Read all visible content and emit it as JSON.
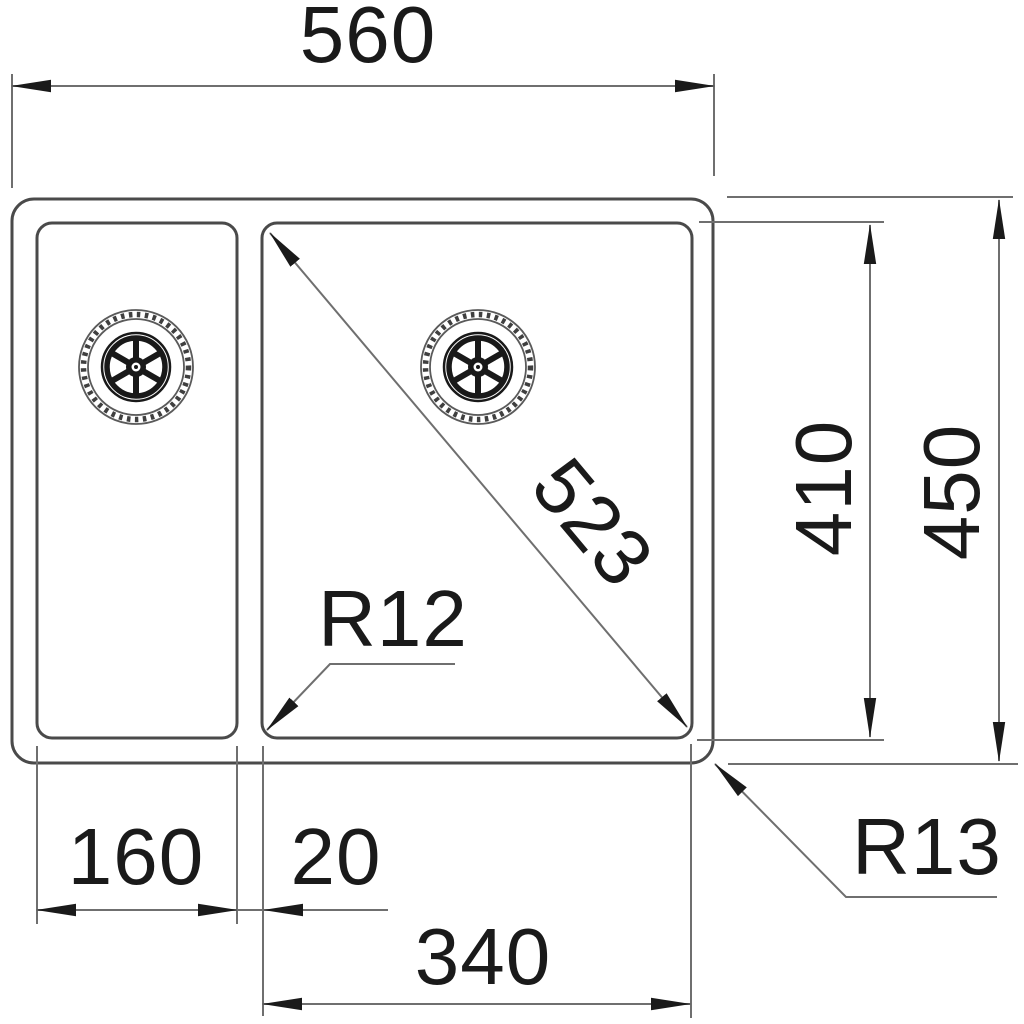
{
  "drawing": {
    "subject": "one-and-a-half-bowl sink top view dimension drawing",
    "labels": {
      "overall_width": "560",
      "overall_depth": "450",
      "bowl_depth": "410",
      "bowl_diagonal": "523",
      "left_bowl_width": "160",
      "divider_width": "20",
      "right_bowl_width": "340",
      "inner_corner_radius": "R12",
      "outer_corner_radius": "R13"
    },
    "colors": {
      "background": "#ffffff",
      "outline": "#4a4a4a",
      "dimension_line": "#6f6f6f",
      "text": "#1a1a1a",
      "arrow": "#1a1a1a"
    }
  }
}
